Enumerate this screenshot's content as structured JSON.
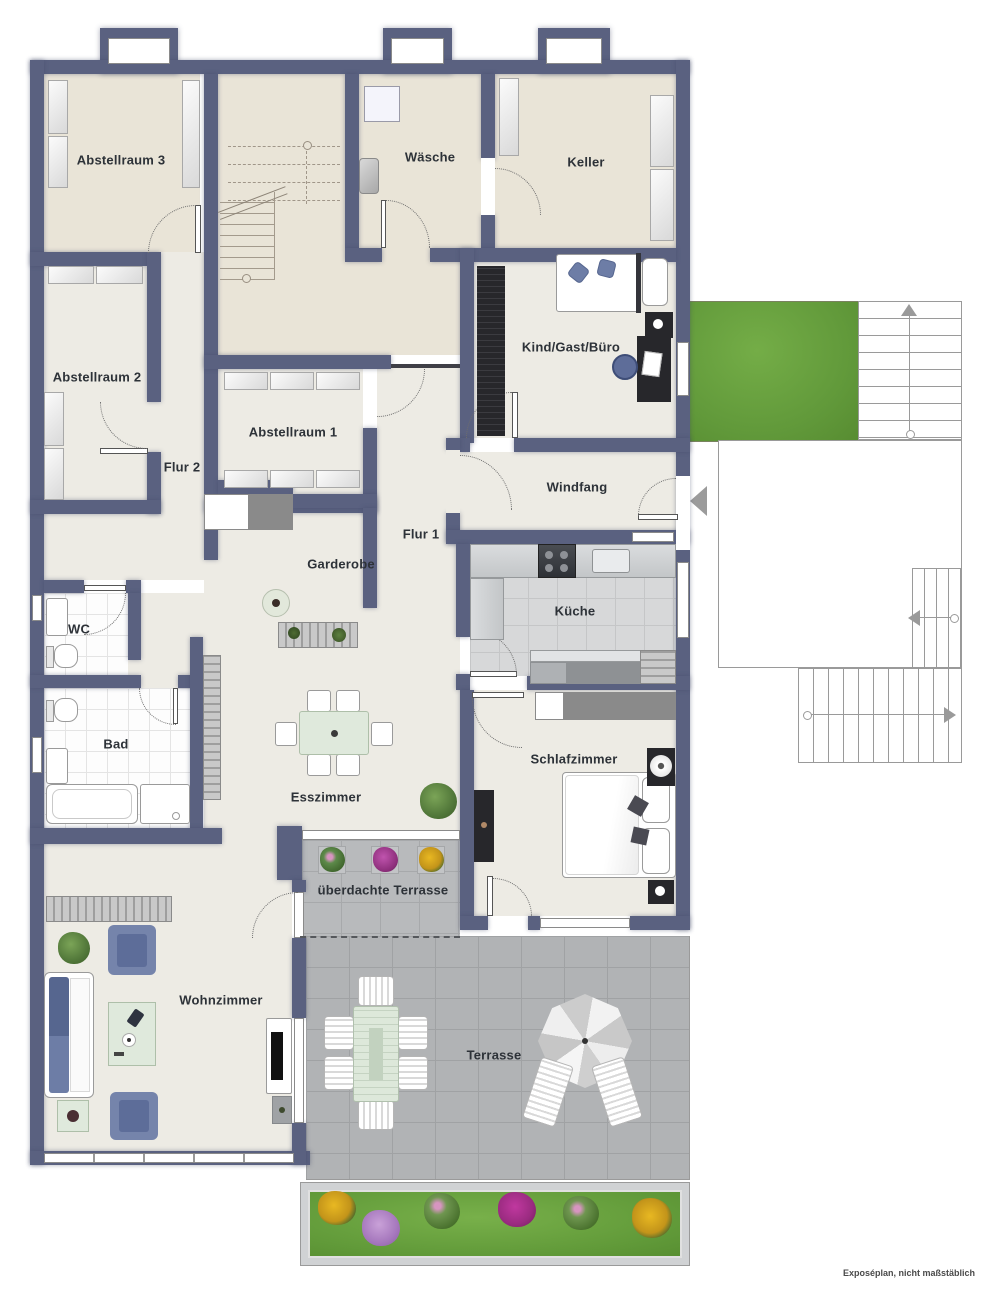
{
  "note": "Exposéplan, nicht maßstäblich",
  "rooms": {
    "abstellraum3": "Abstellraum 3",
    "waesche": "Wäsche",
    "keller": "Keller",
    "abstellraum2": "Abstellraum 2",
    "abstellraum1": "Abstellraum 1",
    "kind_gast_buero": "Kind/Gast/Büro",
    "flur2": "Flur 2",
    "windfang": "Windfang",
    "flur1": "Flur 1",
    "garderobe": "Garderobe",
    "wc": "WC",
    "kueche": "Küche",
    "bad": "Bad",
    "esszimmer": "Esszimmer",
    "schlafzimmer": "Schlafzimmer",
    "ueberdachte_terrasse": "überdachte Terrasse",
    "wohnzimmer": "Wohnzimmer",
    "terrasse": "Terrasse"
  },
  "colors": {
    "wall": "#5a6180",
    "floor_storage": "#e9e4d7",
    "floor_living": "#edebe4",
    "floor_tile": "#fdfdfd",
    "floor_kitchen": "#d7d8d9",
    "terrace_paving": "#b1b3b5",
    "covered_terrace_paving": "#b8babc",
    "lawn": "#68a23e",
    "accent_blue": "#6d7da6",
    "furniture_dark": "#27272b",
    "table_green": "#dfe9dc",
    "flower_yellow": "#e3af1f",
    "flower_purple": "#b383c9",
    "flower_magenta": "#b0399f"
  }
}
